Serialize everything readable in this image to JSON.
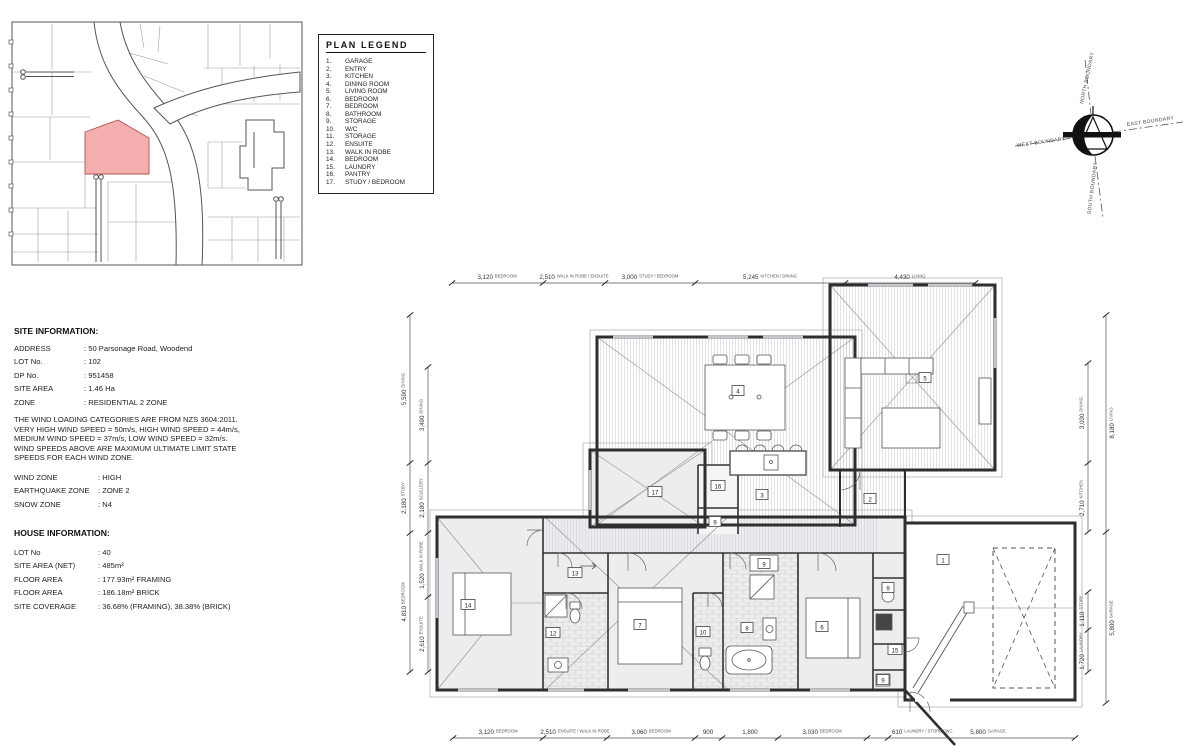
{
  "colors": {
    "highlight_lot": "#f5aeae",
    "wall": "#2e2e2e",
    "paper": "#ffffff"
  },
  "legend": {
    "title": "PLAN LEGEND",
    "items": [
      {
        "num": "1.",
        "name": "GARAGE"
      },
      {
        "num": "2.",
        "name": "ENTRY"
      },
      {
        "num": "3.",
        "name": "KITCHEN"
      },
      {
        "num": "4.",
        "name": "DINING ROOM"
      },
      {
        "num": "5.",
        "name": "LIVING ROOM"
      },
      {
        "num": "6.",
        "name": "BEDROOM"
      },
      {
        "num": "7.",
        "name": "BEDROOM"
      },
      {
        "num": "8.",
        "name": "BATHROOM"
      },
      {
        "num": "9.",
        "name": "STORAGE"
      },
      {
        "num": "10.",
        "name": "W/C"
      },
      {
        "num": "11.",
        "name": "STORAGE"
      },
      {
        "num": "12.",
        "name": "ENSUITE"
      },
      {
        "num": "13.",
        "name": "WALK IN ROBE"
      },
      {
        "num": "14.",
        "name": "BEDROOM"
      },
      {
        "num": "15.",
        "name": "LAUNDRY"
      },
      {
        "num": "16.",
        "name": "PANTRY"
      },
      {
        "num": "17.",
        "name": "STUDY / BEDROOM"
      }
    ]
  },
  "compass": {
    "north": "NORTH BOUNDARY",
    "east": "EAST BOUNDARY",
    "south": "SOUTH BOUNDARY",
    "west": "WEST BOUNDARY"
  },
  "site_info": {
    "title": "SITE INFORMATION:",
    "rows": [
      {
        "label": "ADDRESS",
        "value": ": 50 Parsonage Road, Woodend"
      },
      {
        "label": "LOT No.",
        "value": ": 102"
      },
      {
        "label": "DP No.",
        "value": ": 951458"
      },
      {
        "label": "SITE AREA",
        "value": ": 1.46 Ha"
      },
      {
        "label": "ZONE",
        "value": ": RESIDENTIAL 2 ZONE"
      }
    ],
    "wind_note": "THE WIND LOADING CATEGORIES ARE FROM NZS 3604:2011. VERY HIGH WIND SPEED = 50m/s, HIGH WIND SPEED = 44m/s, MEDIUM WIND SPEED = 37m/s, LOW WIND SPEED = 32m/s. WIND SPEEDS ABOVE ARE MAXIMUM ULTIMATE LIMIT STATE SPEEDS FOR EACH WIND ZONE.",
    "zone_rows": [
      {
        "label": "WIND ZONE",
        "value": ": HIGH"
      },
      {
        "label": "EARTHQUAKE ZONE",
        "value": ": ZONE 2"
      },
      {
        "label": "SNOW ZONE",
        "value": ": N4"
      }
    ]
  },
  "house_info": {
    "title": "HOUSE INFORMATION:",
    "rows": [
      {
        "label": "LOT No",
        "value": ": 40"
      },
      {
        "label": "SITE AREA (NET)",
        "value": ": 485m²"
      },
      {
        "label": "FLOOR AREA",
        "value": ": 177.93m² FRAMING"
      },
      {
        "label": "FLOOR AREA",
        "value": ": 186.18m² BRICK"
      },
      {
        "label": "SITE COVERAGE",
        "value": ": 36.68% (FRAMING), 38.38% (BRICK)"
      }
    ]
  },
  "plan": {
    "dims_top": [
      {
        "value": "3,120",
        "name": "BEDROOM"
      },
      {
        "value": "2,510",
        "name": "WALK IN ROBE / ENSUITE"
      },
      {
        "value": "3,000",
        "name": "STUDY / BEDROOM"
      },
      {
        "value": "5,245",
        "name": "KITCHEN / DINING"
      },
      {
        "value": "4,430",
        "name": "LIVING"
      }
    ],
    "dims_bottom": [
      {
        "value": "3,120",
        "name": "BEDROOM"
      },
      {
        "value": "2,510",
        "name": "ENSUITE / WALK IN ROBE"
      },
      {
        "value": "3,060",
        "name": "BEDROOM"
      },
      {
        "value": "900",
        "name": ""
      },
      {
        "value": "1,800",
        "name": ""
      },
      {
        "value": "3,030",
        "name": "BEDROOM"
      },
      {
        "value": "610",
        "name": "LAUNDRY / STORE / WC"
      },
      {
        "value": "5,800",
        "name": "GARAGE"
      }
    ],
    "dims_left": [
      {
        "value": "5,590",
        "name": "DINING"
      },
      {
        "value": "2,180",
        "name": "STUDY"
      },
      {
        "value": "4,810",
        "name": "BEDROOM"
      },
      {
        "value": "3,490",
        "name": "DINING"
      },
      {
        "value": "2,180",
        "name": "SCULLERY"
      },
      {
        "value": "1,520",
        "name": "WALK IN ROBE"
      },
      {
        "value": "2,610",
        "name": "ENSUITE"
      }
    ],
    "dims_right": [
      {
        "value": "8,180",
        "name": "LIVING"
      },
      {
        "value": "5,800",
        "name": "GARAGE"
      },
      {
        "value": "3,030",
        "name": "DINING"
      },
      {
        "value": "2,710",
        "name": "KITCHEN"
      },
      {
        "value": "1,110",
        "name": "STORE"
      },
      {
        "value": "1,720",
        "name": "LAUNDRY"
      }
    ],
    "room_numbers": {
      "garage": "1",
      "entry": "2",
      "kitchen": "3",
      "dining": "4",
      "living": "5",
      "bedroom6": "6",
      "bedroom7": "7",
      "bathroom": "8",
      "linen": "9",
      "store_b": "9",
      "store_c": "9",
      "store_d": "9",
      "wc": "10",
      "ensuite": "12",
      "wir": "13",
      "bedroom14": "14",
      "laundry": "15",
      "pantry": "16",
      "study": "17"
    }
  }
}
